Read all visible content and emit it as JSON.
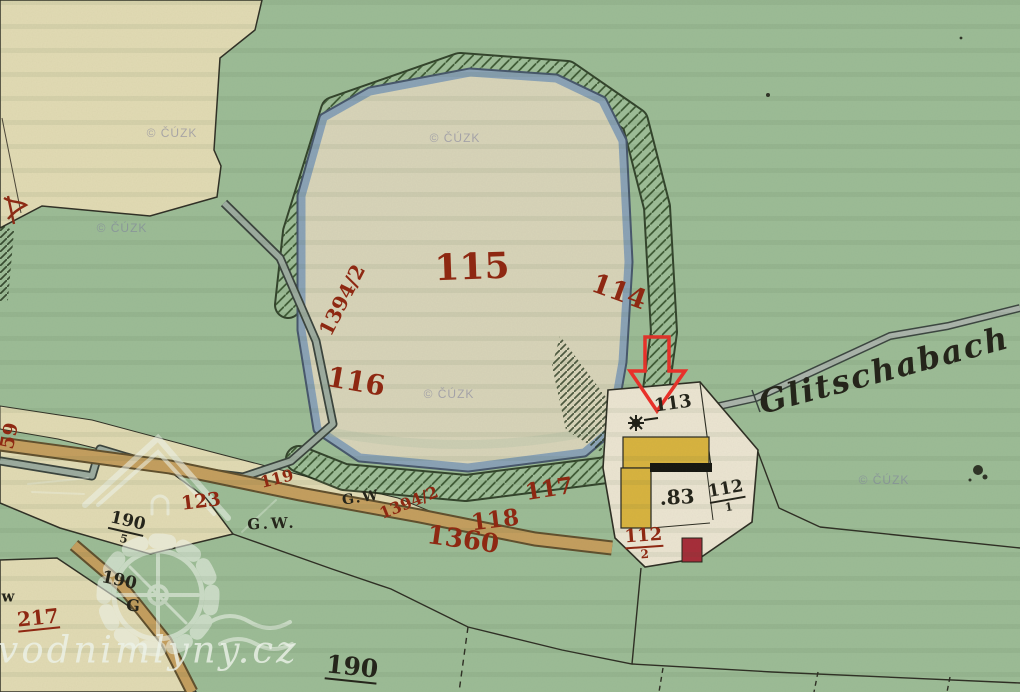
{
  "map": {
    "description": "Historic cadastral map sheet (imperial survey) showing a dried pond, dam, roads and a water mill farmstead",
    "stream_name": "Glitschabach",
    "mill_house_number": ".83",
    "labels": [
      {
        "id": "parcel-115-pond",
        "text": "115",
        "x": 472,
        "y": 267,
        "rot": -2,
        "size": 36,
        "color": "red"
      },
      {
        "id": "parcel-114-dam",
        "text": "114",
        "x": 619,
        "y": 292,
        "rot": 20,
        "size": 27,
        "color": "red"
      },
      {
        "id": "parcel-116",
        "text": "116",
        "x": 356,
        "y": 382,
        "rot": 10,
        "size": 28,
        "color": "red"
      },
      {
        "id": "parcel-117",
        "text": "117",
        "x": 549,
        "y": 489,
        "rot": -9,
        "size": 23,
        "color": "red"
      },
      {
        "id": "parcel-118",
        "text": "118",
        "x": 495,
        "y": 520,
        "rot": -7,
        "size": 23,
        "color": "red"
      },
      {
        "id": "parcel-119",
        "text": "119",
        "x": 277,
        "y": 479,
        "rot": -14,
        "size": 16,
        "color": "red"
      },
      {
        "id": "parcel-123",
        "text": "123",
        "x": 201,
        "y": 502,
        "rot": -7,
        "size": 19,
        "color": "red"
      },
      {
        "id": "road-1360",
        "text": "1360",
        "x": 463,
        "y": 540,
        "rot": 8,
        "size": 26,
        "color": "red"
      },
      {
        "id": "path-1394-2-upper",
        "text": "1394/2",
        "x": 342,
        "y": 300,
        "rot": -63,
        "size": 20,
        "color": "red"
      },
      {
        "id": "path-1394-2-lower",
        "text": "1394/2",
        "x": 409,
        "y": 503,
        "rot": -22,
        "size": 16,
        "color": "red"
      },
      {
        "id": "parcel-59-edge",
        "text": "59",
        "x": 10,
        "y": 436,
        "rot": -78,
        "size": 19,
        "color": "red"
      },
      {
        "id": "parcel-217",
        "text": "217",
        "x": 38,
        "y": 619,
        "rot": -6,
        "size": 20,
        "color": "red",
        "underline": true
      },
      {
        "id": "parcel-112-2",
        "text": "112",
        "den": "2",
        "x": 644,
        "y": 544,
        "rot": -4,
        "size": 18,
        "color": "red",
        "underline": true
      },
      {
        "id": "parcel-112-1",
        "text": "112",
        "den": "1",
        "x": 727,
        "y": 497,
        "rot": -10,
        "size": 17,
        "color": "black",
        "underline": true
      },
      {
        "id": "parcel-190-5",
        "text": "190",
        "den": "5",
        "x": 126,
        "y": 529,
        "rot": 13,
        "size": 17,
        "color": "black",
        "underline": true
      },
      {
        "id": "parcel-190-g",
        "text": "190",
        "x": 119,
        "y": 581,
        "rot": 12,
        "size": 17,
        "color": "black"
      },
      {
        "id": "grass-mark-g",
        "text": "G",
        "x": 133,
        "y": 606,
        "rot": 4,
        "size": 16,
        "color": "black"
      },
      {
        "id": "parcel-190-bottom",
        "text": "190",
        "x": 352,
        "y": 668,
        "rot": 6,
        "size": 25,
        "color": "black",
        "underline": true
      },
      {
        "id": "parcel-113",
        "text": "113",
        "x": 673,
        "y": 404,
        "rot": -8,
        "size": 18,
        "color": "black"
      },
      {
        "id": "house-number-83",
        "text": ".83",
        "x": 677,
        "y": 497,
        "rot": -3,
        "size": 20,
        "color": "black"
      },
      {
        "id": "mark-w-edge",
        "text": "w",
        "x": 8,
        "y": 597,
        "rot": 0,
        "size": 15,
        "color": "black"
      },
      {
        "id": "mark-gw-1",
        "text": "G.W.",
        "x": 272,
        "y": 524,
        "rot": -2,
        "size": 15,
        "color": "black",
        "ls": 3
      },
      {
        "id": "mark-gw-2",
        "text": "G.W",
        "x": 361,
        "y": 498,
        "rot": -8,
        "size": 14,
        "color": "black",
        "ls": 2
      },
      {
        "id": "stream-name",
        "text": "Glitschabach",
        "x": 884,
        "y": 370,
        "rot": -15,
        "size": 32,
        "color": "black",
        "script": true
      }
    ],
    "watermarks": {
      "copyright_text": "© ČÚZK",
      "copyright_positions": [
        {
          "x": 172,
          "y": 133
        },
        {
          "x": 122,
          "y": 228
        },
        {
          "x": 455,
          "y": 138
        },
        {
          "x": 449,
          "y": 394
        },
        {
          "x": 884,
          "y": 480
        }
      ],
      "site_text": "vodnimlyny.cz",
      "site_position": {
        "x": 148,
        "y": 650
      }
    },
    "annotations": {
      "arrow_meaning": "red arrow marking the water mill location",
      "wheel_symbol_meaning": "water-wheel symbol of the mill"
    },
    "colors": {
      "meadow_green": "#9cbc96",
      "field_beige": "#e2dbb4",
      "pond_fill": "#d8d4b9",
      "pond_border_blue": "#8aa2b6",
      "road_tan": "#c49e5e",
      "building_yellow": "#d8b33e",
      "building_red": "#a62b38",
      "label_red": "#8e2812",
      "ink_black": "#25251b",
      "arrow_red": "#e8312a"
    }
  }
}
